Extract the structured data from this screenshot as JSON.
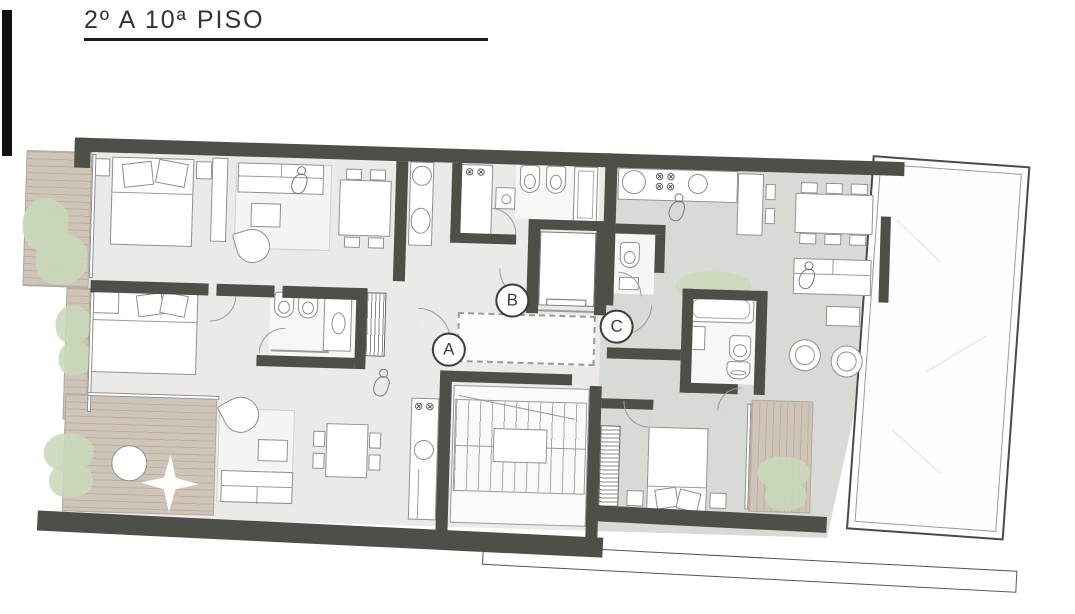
{
  "header": {
    "title": "2º A 10ª PISO"
  },
  "plan": {
    "unit_labels": [
      {
        "id": "A",
        "label": "A"
      },
      {
        "id": "B",
        "label": "B"
      },
      {
        "id": "C",
        "label": "C"
      }
    ],
    "glyphs": {
      "burner_row": "⊗⊗"
    },
    "colors": {
      "wall": "#4f4f49",
      "floor_units_ab": "#eceae8",
      "floor_unit_c": "#d8dad6",
      "deck_wood": "#cec5b8",
      "plant_green": "#c9d8ba",
      "furniture_outline": "#8f8f8f",
      "terrace_outline": "#555555",
      "title_text": "#333333"
    }
  }
}
